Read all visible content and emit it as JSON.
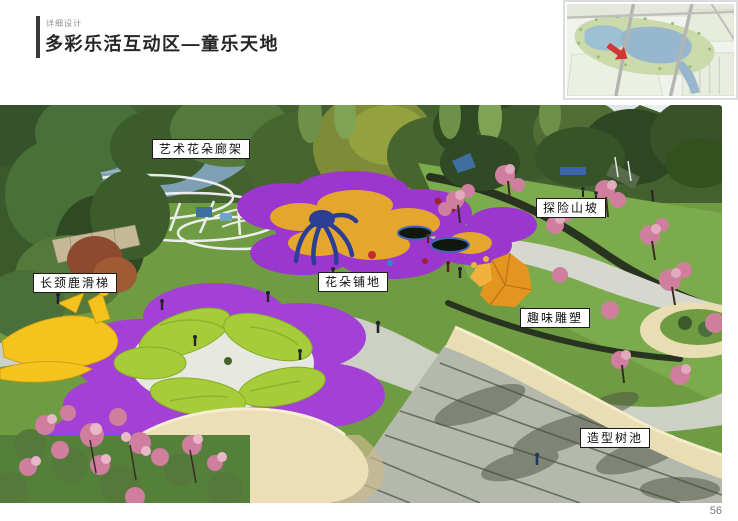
{
  "header": {
    "eyebrow": "详细设计",
    "title": "多彩乐活互动区—童乐天地"
  },
  "callouts": {
    "art_flower_pergola": "艺术花朵廊架",
    "adventure_hill": "探险山坡",
    "giraffe_slide": "长颈鹿滑梯",
    "flower_paving": "花朵铺地",
    "fun_sculpture": "趣味雕塑",
    "shaped_tree_pool": "造型树池"
  },
  "footer": {
    "page_number": "56"
  },
  "colors": {
    "accent_bar": "#3a3a3a",
    "title_color": "#262626",
    "eyebrow_color": "#8f8f8f",
    "label_bg": "#ffffff",
    "label_border": "#1c1c1c",
    "page_number_color": "#787878",
    "purple_paving": "#a341d6",
    "yellow_paving": "#e5a62d",
    "mound_green": "#a6cc39",
    "lawn_green": "#6f9c42",
    "path_gray": "#ccd0c5",
    "planter_cream": "#e9ddb4",
    "stairs_gray": "#b5b9ad",
    "map_arrow_red": "#c81414",
    "lake_blue": "#85abc6"
  }
}
